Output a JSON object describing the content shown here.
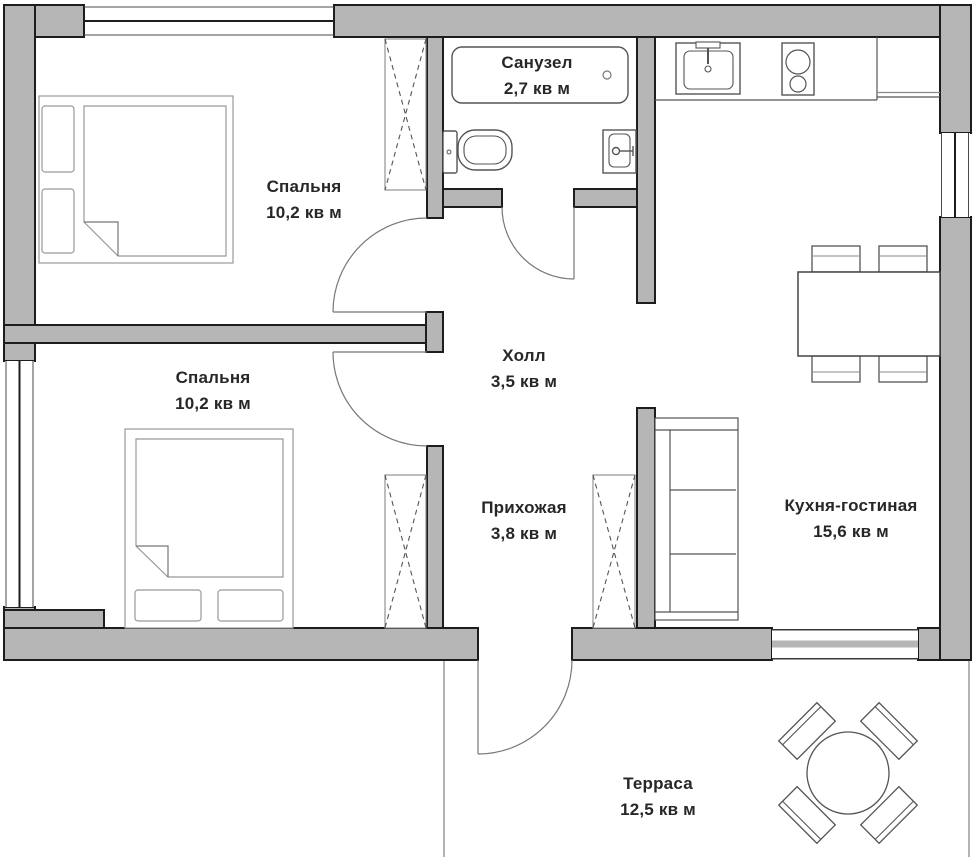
{
  "plan": {
    "type": "apartment-floor-plan",
    "language": "ru",
    "area_unit": "кв м"
  },
  "rooms": [
    {
      "name": "Спальня",
      "area": "10,2 кв м"
    },
    {
      "name": "Санузел",
      "area": "2,7 кв м"
    },
    {
      "name": "Спальня",
      "area": "10,2 кв м"
    },
    {
      "name": "Холл",
      "area": "3,5 кв м"
    },
    {
      "name": "Прихожая",
      "area": "3,8 кв м"
    },
    {
      "name": "Кухня-гостиная",
      "area": "15,6 кв м"
    },
    {
      "name": "Терраса",
      "area": "12,5 кв м"
    }
  ],
  "symbols": [
    "double-bed",
    "pillow",
    "wardrobe-dashed",
    "bathtub",
    "toilet",
    "washbasin",
    "kitchen-sink",
    "cooktop-2-burners",
    "kitchen-counter",
    "dining-table",
    "dining-chair",
    "shelving-unit",
    "round-terrace-table",
    "terrace-chair",
    "door-swing",
    "window",
    "sliding-window"
  ],
  "colors": {
    "background": "#ffffff",
    "wall_fill": "#b6b6b6",
    "wall_outline": "#1d1d1d",
    "window_line": "#3a3a3a",
    "door_line": "#777777",
    "fixture_line": "#555555",
    "furniture_line": "#999999",
    "text": "#27272a"
  }
}
